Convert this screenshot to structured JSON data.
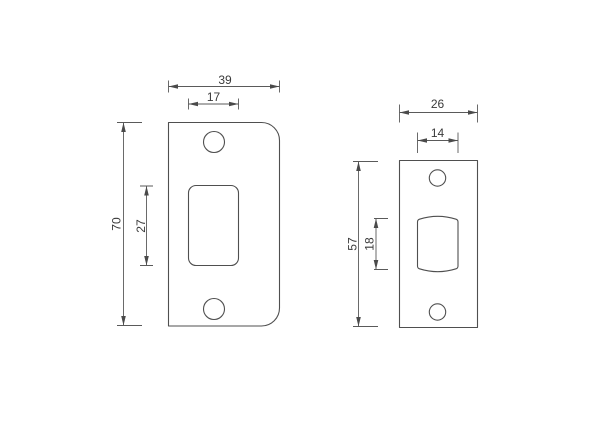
{
  "canvas": {
    "width": "600",
    "height": "424",
    "background": "#ffffff"
  },
  "style": {
    "outline_color": "#4f4f4f",
    "dimension_color": "#5a5a5a",
    "text_color": "#3a3a3a"
  },
  "plates": [
    {
      "name": "large strike plate with radiused right corners",
      "dims": {
        "overall_width": "39",
        "cutout_width": "17",
        "overall_height": "70",
        "cutout_height": "27"
      }
    },
    {
      "name": "small square-corner latch strike plate",
      "dims": {
        "overall_width": "26",
        "cutout_width": "14",
        "overall_height": "57",
        "cutout_height": "18"
      }
    }
  ]
}
